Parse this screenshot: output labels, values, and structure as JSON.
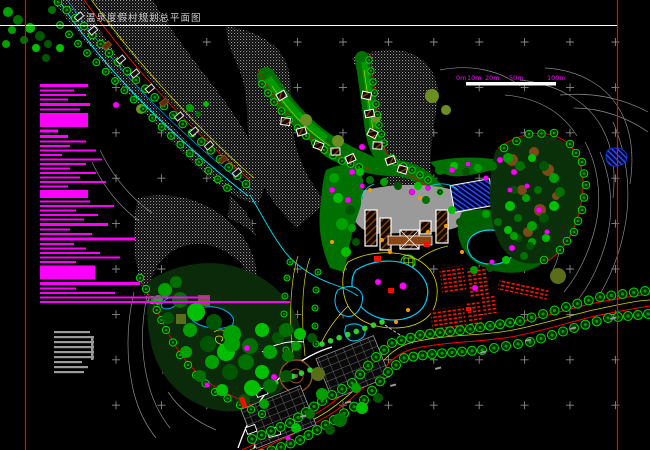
{
  "title": {
    "text": "温泉度假村规划总平面图"
  },
  "scalebar": {
    "labels": [
      {
        "t": "0m",
        "x": 456
      },
      {
        "t": "10m",
        "x": 467
      },
      {
        "t": "20m",
        "x": 485
      },
      {
        "t": "50m",
        "x": 509
      },
      {
        "t": "100m",
        "x": 547
      }
    ],
    "bar": {
      "x": 466,
      "y": 82,
      "w": 90,
      "h": 3.5,
      "color": "#ffffff"
    },
    "label_color": "#ff00ff",
    "label_y": 80
  },
  "legend": {
    "x": 40,
    "y_start": 84,
    "gap": 2.5,
    "color": "#ff00ff",
    "bars": [
      [
        48,
        3
      ],
      [
        34,
        2
      ],
      [
        46,
        2
      ],
      [
        28,
        2
      ],
      [
        50,
        3
      ],
      [
        40,
        2
      ],
      [
        48,
        14
      ],
      [
        18,
        3
      ],
      [
        28,
        3
      ],
      [
        46,
        2
      ],
      [
        30,
        2
      ],
      [
        56,
        2
      ],
      [
        22,
        2
      ],
      [
        62,
        2
      ],
      [
        46,
        2
      ],
      [
        30,
        2
      ],
      [
        56,
        2
      ],
      [
        40,
        2
      ],
      [
        66,
        2
      ],
      [
        28,
        2
      ],
      [
        48,
        8
      ],
      [
        50,
        2
      ],
      [
        74,
        2
      ],
      [
        36,
        2
      ],
      [
        58,
        2
      ],
      [
        44,
        2
      ],
      [
        68,
        3
      ],
      [
        30,
        2
      ],
      [
        52,
        2
      ],
      [
        95,
        3
      ],
      [
        34,
        2
      ],
      [
        46,
        2
      ],
      [
        60,
        2
      ],
      [
        80,
        2
      ],
      [
        36,
        2
      ],
      [
        55,
        14
      ],
      [
        100,
        3
      ],
      [
        36,
        2
      ],
      [
        75,
        2
      ],
      [
        170,
        2
      ],
      [
        250,
        2
      ]
    ]
  },
  "notes": {
    "x": 54,
    "y_start": 331,
    "h": 2.2,
    "gap": 2.8,
    "color": "#9a9a9a",
    "bars": [
      36,
      40,
      40,
      40,
      40,
      40,
      28,
      34,
      30
    ],
    "bracket": {
      "x": 91,
      "y": 336,
      "w": 2.5,
      "h": 24
    }
  },
  "grid": {
    "x0": 116,
    "y0": 42,
    "dx": 45.4,
    "dy": 45.4,
    "nx": 12,
    "ny": 9,
    "color": "#8a8a8a"
  },
  "frame": {
    "left_x": 25.5,
    "right_x": 617.5,
    "top_y": 25.5,
    "vertical_color": "#ff0000",
    "horizontal_color": "#ffffff"
  },
  "colors": {
    "background": "#000000",
    "terrain_stipple": "#9a9a9a",
    "contour_line": "#8a8a8a",
    "water_edge": "#00ccff",
    "stream": "#00e5ff",
    "pool_hatch": "#2b50ff",
    "vegetation_bright": "#00dd00",
    "vegetation_mid": "#00a000",
    "vegetation_dark": "#005500",
    "olive": "#6b8e23",
    "road_yellow": "#d9d900",
    "boundary_red": "#ff0000",
    "building_outline": "#ffffff",
    "building_hatch": "#8b4513",
    "terrace_red": "#ff1a00",
    "flower_magenta": "#ff00ff",
    "accent_orange": "#ff9900"
  }
}
